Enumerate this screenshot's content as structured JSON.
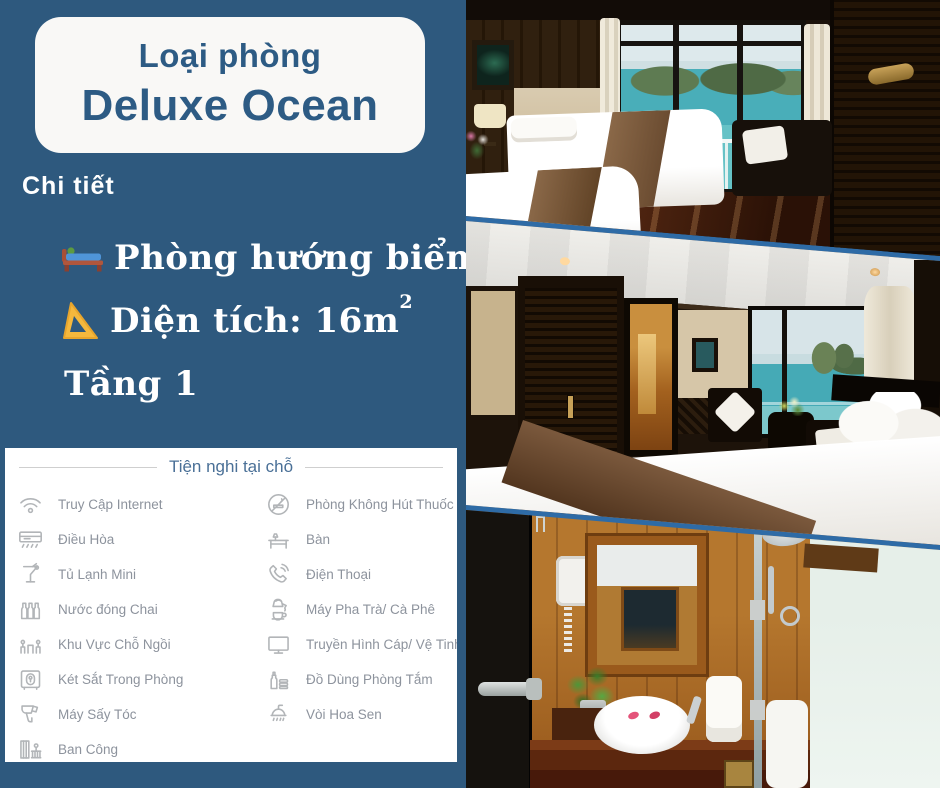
{
  "page": {
    "background_color": "#2e597e",
    "separator_color": "#2e6ba6",
    "accent_text_color": "#2d5b84"
  },
  "header_card": {
    "label": "Loại phòng",
    "room_type": "Deluxe Ocean"
  },
  "details": {
    "section_label": "Chi tiết",
    "items": [
      {
        "icon": "bed-icon",
        "text": "Phòng hướng biển"
      },
      {
        "icon": "triangle-ruler-icon",
        "text": "Diện tích: 16m",
        "superscript": "2"
      },
      {
        "icon": "none",
        "text": "Tầng 1"
      }
    ]
  },
  "amenities": {
    "title": "Tiện nghi tại chỗ",
    "title_color": "#4a7097",
    "label_color": "#8d939d",
    "left_column": [
      {
        "icon": "wifi-icon",
        "label": "Truy Cập Internet"
      },
      {
        "icon": "air-conditioner-icon",
        "label": "Điều Hòa"
      },
      {
        "icon": "minibar-icon",
        "label": "Tủ Lạnh Mini"
      },
      {
        "icon": "bottled-water-icon",
        "label": "Nước đóng Chai"
      },
      {
        "icon": "seating-area-icon",
        "label": "Khu Vực Chỗ Ngồi"
      },
      {
        "icon": "in-room-safe-icon",
        "label": "Két Sắt Trong Phòng"
      },
      {
        "icon": "hairdryer-icon",
        "label": "Máy Sấy Tóc"
      },
      {
        "icon": "balcony-icon",
        "label": "Ban Công"
      }
    ],
    "right_column": [
      {
        "icon": "no-smoking-icon",
        "label": "Phòng Không Hút Thuốc"
      },
      {
        "icon": "desk-icon",
        "label": "Bàn"
      },
      {
        "icon": "telephone-icon",
        "label": "Điện Thoại"
      },
      {
        "icon": "tea-coffee-maker-icon",
        "label": "Máy Pha Trà/ Cà Phê"
      },
      {
        "icon": "cable-tv-icon",
        "label": "Truyền Hình Cáp/ Vệ Tinh"
      },
      {
        "icon": "toiletries-icon",
        "label": "Đồ Dùng Phòng Tắm"
      },
      {
        "icon": "shower-icon",
        "label": "Vòi Hoa Sen"
      }
    ]
  },
  "photos": {
    "items": [
      {
        "name": "twin-bedroom-ocean-view"
      },
      {
        "name": "double-bedroom-ocean-view"
      },
      {
        "name": "bathroom"
      }
    ]
  }
}
